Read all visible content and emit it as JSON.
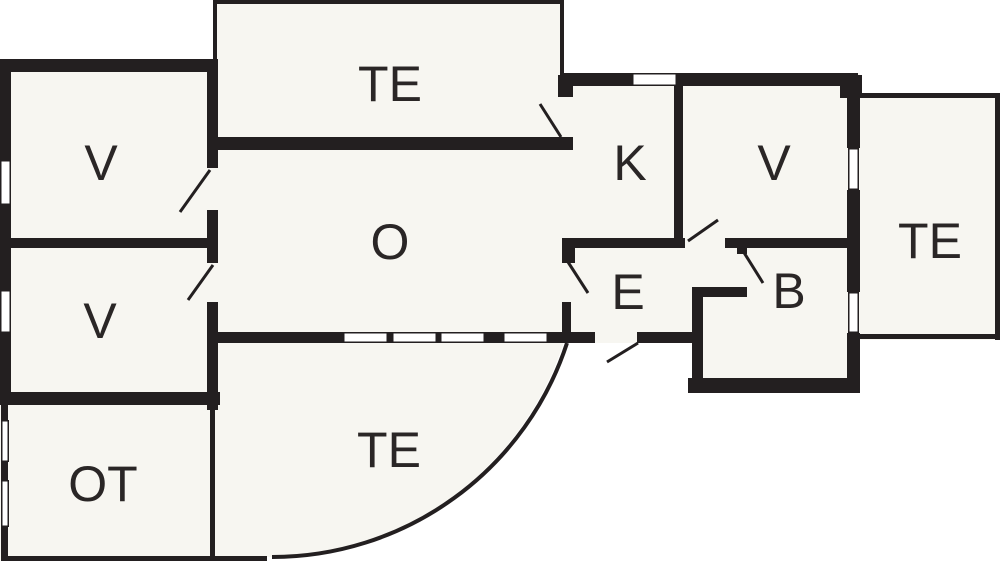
{
  "diagram": {
    "type": "floor-plan",
    "canvas": {
      "width": 1000,
      "height": 564
    },
    "colors": {
      "background": "#ffffff",
      "room_fill": "#f7f6f1",
      "wall": "#231f20",
      "label": "#2a2626"
    },
    "label_font_size": 50,
    "rooms": [
      {
        "id": "v-top-left",
        "label": "V",
        "cx": 101,
        "cy": 163
      },
      {
        "id": "v-bottom-left",
        "label": "V",
        "cx": 100,
        "cy": 321
      },
      {
        "id": "ot",
        "label": "OT",
        "cx": 103,
        "cy": 484
      },
      {
        "id": "te-top",
        "label": "TE",
        "cx": 390,
        "cy": 84
      },
      {
        "id": "o",
        "label": "O",
        "cx": 390,
        "cy": 242
      },
      {
        "id": "k",
        "label": "K",
        "cx": 630,
        "cy": 163
      },
      {
        "id": "v-right",
        "label": "V",
        "cx": 774,
        "cy": 163
      },
      {
        "id": "e",
        "label": "E",
        "cx": 628,
        "cy": 292
      },
      {
        "id": "b",
        "label": "B",
        "cx": 789,
        "cy": 291
      },
      {
        "id": "te-bottom",
        "label": "TE",
        "cx": 389,
        "cy": 450
      },
      {
        "id": "te-right",
        "label": "TE",
        "cx": 930,
        "cy": 241
      }
    ],
    "fills": {
      "rects": [
        [
          213,
          0,
          351,
          150
        ],
        [
          0,
          59,
          218,
          502
        ],
        [
          208,
          73,
          495,
          270
        ],
        [
          675,
          73,
          185,
          270
        ],
        [
          692,
          297,
          168,
          96
        ],
        [
          858,
          93,
          142,
          247
        ]
      ],
      "paths": [
        "M 215 332 H 567 A 310 310 0 0 1 272 557 L 215 557 Z"
      ]
    },
    "walls": {
      "thick": [
        [
          0,
          59,
          11,
          101
        ],
        [
          0,
          205,
          11,
          85
        ],
        [
          0,
          333,
          11,
          72
        ],
        [
          0,
          59,
          218,
          13
        ],
        [
          0,
          238,
          207,
          10
        ],
        [
          0,
          392,
          220,
          13
        ],
        [
          207,
          59,
          11,
          109
        ],
        [
          207,
          210,
          11,
          53
        ],
        [
          207,
          302,
          11,
          108
        ],
        [
          213,
          137,
          360,
          13
        ],
        [
          558,
          75,
          15,
          22
        ],
        [
          560,
          73,
          72,
          13
        ],
        [
          677,
          73,
          181,
          13
        ],
        [
          840,
          75,
          22,
          23
        ],
        [
          674,
          86,
          9,
          162
        ],
        [
          847,
          75,
          13,
          73
        ],
        [
          847,
          190,
          13,
          102
        ],
        [
          847,
          333,
          13,
          60
        ],
        [
          562,
          238,
          123,
          10
        ],
        [
          725,
          238,
          122,
          10
        ],
        [
          562,
          238,
          13,
          25
        ],
        [
          562,
          302,
          9,
          30
        ],
        [
          737,
          247,
          10,
          7
        ],
        [
          692,
          287,
          55,
          10
        ],
        [
          692,
          297,
          11,
          86
        ],
        [
          688,
          378,
          170,
          15
        ],
        [
          215,
          332,
          128,
          11
        ],
        [
          388,
          332,
          4,
          11
        ],
        [
          437,
          332,
          3,
          11
        ],
        [
          485,
          332,
          18,
          11
        ],
        [
          548,
          332,
          47,
          11
        ],
        [
          637,
          332,
          63,
          11
        ]
      ],
      "thin": [
        [
          213,
          0,
          351,
          4
        ],
        [
          213,
          0,
          4,
          60
        ],
        [
          560,
          0,
          4,
          76
        ],
        [
          858,
          93,
          142,
          5
        ],
        [
          995,
          93,
          5,
          247
        ],
        [
          858,
          334,
          142,
          5
        ],
        [
          1,
          405,
          7,
          17
        ],
        [
          1,
          462,
          7,
          18
        ],
        [
          1,
          527,
          7,
          33
        ],
        [
          1,
          556,
          266,
          5
        ],
        [
          210,
          405,
          5,
          156
        ]
      ]
    },
    "windows": [
      [
        0,
        160,
        11,
        45
      ],
      [
        0,
        290,
        11,
        43
      ],
      [
        632,
        73,
        45,
        13
      ],
      [
        848,
        148,
        11,
        42
      ],
      [
        848,
        292,
        11,
        41
      ],
      [
        343,
        332,
        45,
        11
      ],
      [
        392,
        332,
        45,
        11
      ],
      [
        440,
        332,
        45,
        11
      ],
      [
        503,
        332,
        45,
        11
      ],
      [
        1,
        420,
        8,
        42
      ],
      [
        1,
        480,
        8,
        47
      ]
    ],
    "doors": [
      [
        540,
        104,
        561,
        137
      ],
      [
        210,
        170,
        180,
        212
      ],
      [
        213,
        265,
        188,
        300
      ],
      [
        568,
        262,
        588,
        293
      ],
      [
        688,
        241,
        718,
        220
      ],
      [
        743,
        251,
        763,
        283
      ],
      [
        607,
        362,
        638,
        343
      ]
    ],
    "terrace_arc": "M 567 343 A 310 310 0 0 1 272 557"
  }
}
